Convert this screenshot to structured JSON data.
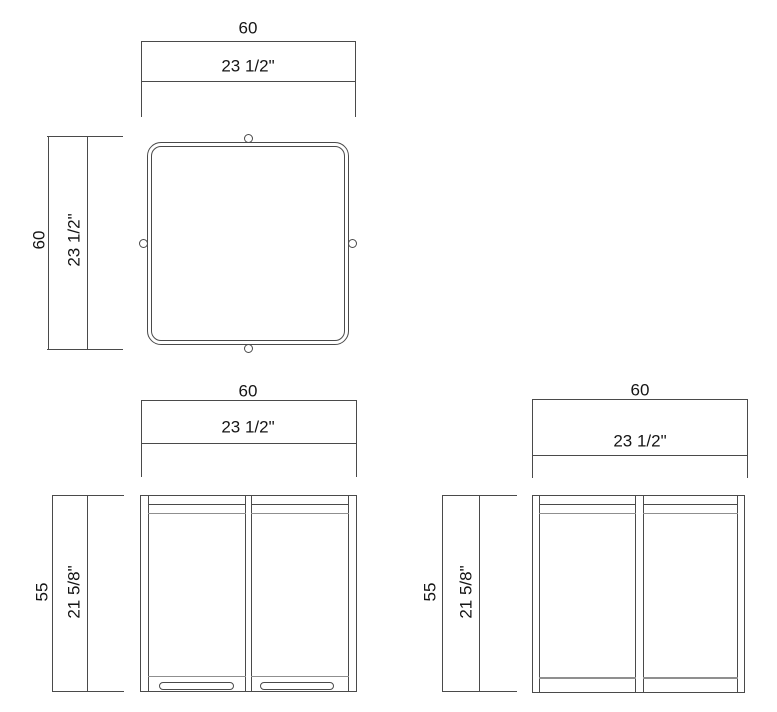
{
  "drawing": {
    "type": "furniture dimension drawing",
    "background_color": "#ffffff",
    "line_color": "#4a4a4a",
    "light_line_color": "#8f8f8f",
    "text_color": "#151515"
  },
  "views": {
    "top": {
      "name": "plan view",
      "width_cm": "60",
      "width_in": "23 1/2\"",
      "depth_cm": "60",
      "depth_in": "23 1/2\""
    },
    "front": {
      "name": "front elevation",
      "width_cm": "60",
      "width_in": "23 1/2\"",
      "height_cm": "55",
      "height_in": "21 5/8\""
    },
    "side": {
      "name": "side elevation",
      "width_cm": "60",
      "width_in": "23 1/2\"",
      "height_cm": "55",
      "height_in": "21 5/8\""
    }
  }
}
